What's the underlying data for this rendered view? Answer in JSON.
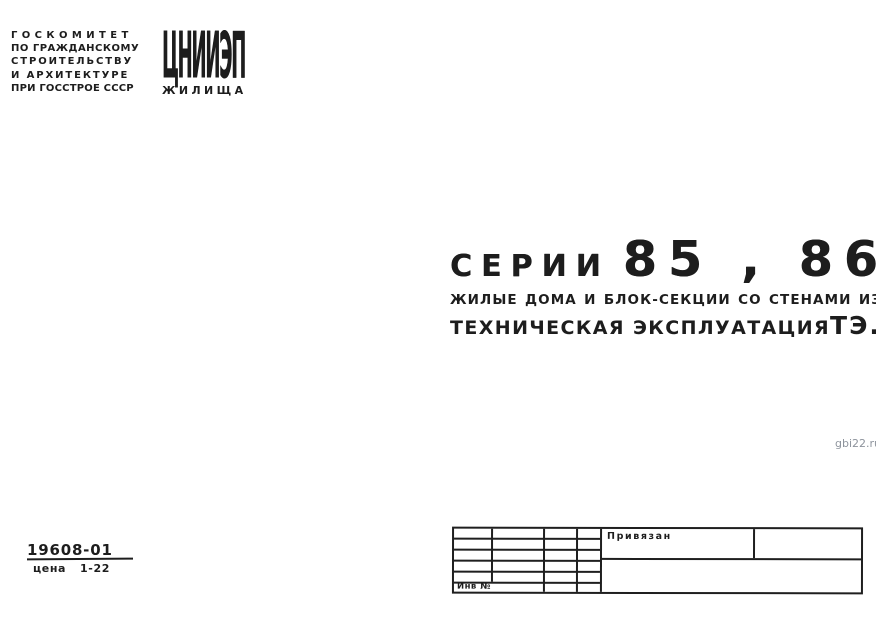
{
  "watermark": "gbi22.ru",
  "colors": {
    "ink": "#1d1d1d",
    "watermark_gray": "#8d939c"
  },
  "header": {
    "committee_lines": [
      "ГОСКОМИТЕТ",
      "ПО ГРАЖДАНСКОМУ",
      "СТРОИТЕЛЬСТВУ",
      "И АРХИТЕКТУРЕ",
      "ПРИ ГОССТРОЕ СССР"
    ],
    "logo_main": "ЦНИИЭП",
    "logo_sub": "ЖИЛИЩА"
  },
  "title": {
    "series_label": "СЕРИИ",
    "series_numbers": "85 , 86",
    "subtitle": "ЖИЛЫЕ ДОМА И БЛОК-СЕКЦИИ СО СТЕНАМИ ИЗ КИРПИЧА",
    "doc_type": "ТЕХНИЧЕСКАЯ ЭКСПЛУАТАЦИЯ",
    "doc_code": "ТЭ.1"
  },
  "footer": {
    "catalog_number": "19608-01",
    "price_label": "цена",
    "price_value": "1-22"
  },
  "stamp": {
    "assigned_label": "Привязан",
    "inventory_label": "Инв №"
  }
}
